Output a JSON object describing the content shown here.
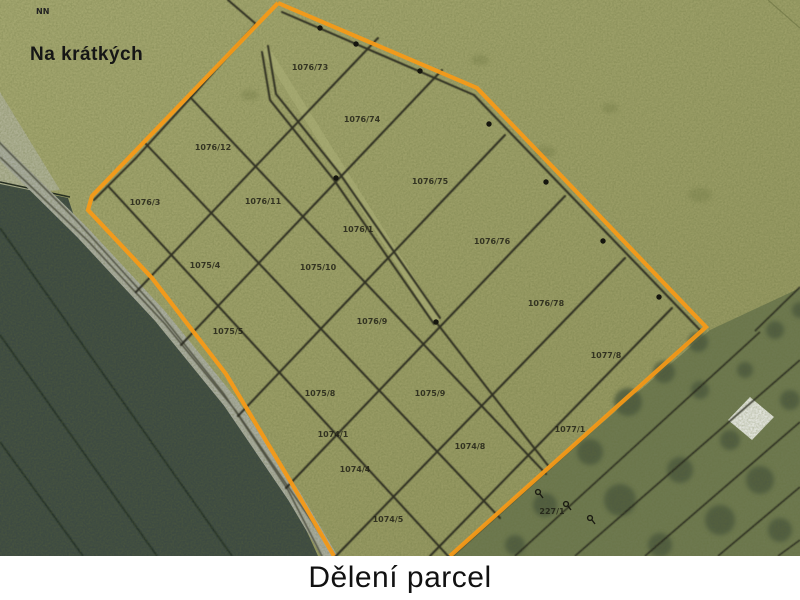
{
  "window": {
    "caption": "Dělení parcel"
  },
  "map": {
    "area_label": "Na krátkých",
    "corner_label": "NN",
    "colors": {
      "grass": "#9a9d66",
      "grass_light": "#a4a770",
      "dark_field": "#3d4a42",
      "road": "#a9ac9f",
      "woodland": "#6e7950",
      "tree": "#49573c",
      "boundary_orange": "#f59a18",
      "parcel_line": "#26261b",
      "building": "#e8eae4",
      "caption_bg": "#ffffff",
      "caption_text": "#111111"
    },
    "parcel_labels": [
      {
        "text": "1076/73",
        "x": 310,
        "y": 70
      },
      {
        "text": "1076/74",
        "x": 362,
        "y": 122
      },
      {
        "text": "1076/75",
        "x": 430,
        "y": 184
      },
      {
        "text": "1076/76",
        "x": 492,
        "y": 244
      },
      {
        "text": "1076/78",
        "x": 546,
        "y": 306
      },
      {
        "text": "1077/8",
        "x": 606,
        "y": 358
      },
      {
        "text": "1077/1",
        "x": 570,
        "y": 432
      },
      {
        "text": "1076/12",
        "x": 213,
        "y": 150
      },
      {
        "text": "1076/3",
        "x": 145,
        "y": 205
      },
      {
        "text": "1076/11",
        "x": 263,
        "y": 204
      },
      {
        "text": "1076/1",
        "x": 358,
        "y": 232
      },
      {
        "text": "1075/4",
        "x": 205,
        "y": 268
      },
      {
        "text": "1075/10",
        "x": 318,
        "y": 270
      },
      {
        "text": "1075/5",
        "x": 228,
        "y": 334
      },
      {
        "text": "1076/9",
        "x": 372,
        "y": 324
      },
      {
        "text": "1075/8",
        "x": 320,
        "y": 396
      },
      {
        "text": "1075/9",
        "x": 430,
        "y": 396
      },
      {
        "text": "1074/8",
        "x": 470,
        "y": 449
      },
      {
        "text": "1074/1",
        "x": 333,
        "y": 437
      },
      {
        "text": "1074/4",
        "x": 355,
        "y": 472
      },
      {
        "text": "1074/5",
        "x": 388,
        "y": 522
      },
      {
        "text": "227/1",
        "x": 552,
        "y": 514
      }
    ],
    "boundary_dots": [
      [
        320,
        28
      ],
      [
        356,
        44
      ],
      [
        420,
        71
      ],
      [
        489,
        124
      ],
      [
        546,
        182
      ],
      [
        603,
        241
      ],
      [
        659,
        297
      ],
      [
        336,
        178
      ],
      [
        436,
        322
      ]
    ],
    "symbols": [
      {
        "name": "map-symbol",
        "x": 538,
        "y": 492
      },
      {
        "name": "map-symbol",
        "x": 566,
        "y": 504
      },
      {
        "name": "map-symbol",
        "x": 590,
        "y": 518
      }
    ]
  }
}
